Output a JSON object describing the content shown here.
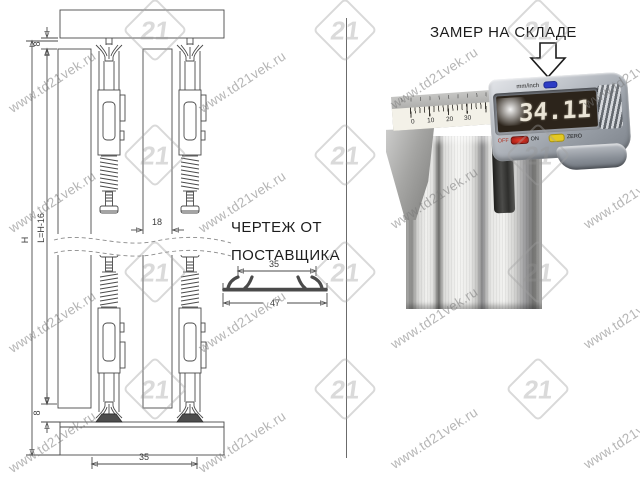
{
  "drawing": {
    "dim_h": "H",
    "dim_l": "L=H-16",
    "dim_8_top": "8",
    "dim_8_bottom": "8",
    "dim_18": "18",
    "dim_35_bottom": "35",
    "profile_dim_35": "35",
    "profile_dim_47": "47",
    "note_line1": "ЧЕРТЕЖ ОТ",
    "note_line2": "ПОСТАВЩИКА"
  },
  "photo": {
    "title": "ЗАМЕР НА СКЛАДЕ",
    "caliper": {
      "display_value": "34.11",
      "unit_label": "mm/inch",
      "off_label": "OFF",
      "on_label": "ON",
      "zero_label": "ZERO",
      "scale_ticks": [
        "0",
        "10",
        "20",
        "30"
      ],
      "colors": {
        "lcd_bg": "#2c241b",
        "unit_button": "#2d3cc5",
        "power_button": "#c62020",
        "zero_button": "#e4c922"
      }
    }
  },
  "watermark": {
    "text": "www.td21vek.ru",
    "logo_text": "21",
    "text_positions": [
      {
        "x": 10,
        "y": 102
      },
      {
        "x": 200,
        "y": 102
      },
      {
        "x": 392,
        "y": 98
      },
      {
        "x": 585,
        "y": 98
      },
      {
        "x": 10,
        "y": 222
      },
      {
        "x": 200,
        "y": 222
      },
      {
        "x": 392,
        "y": 218
      },
      {
        "x": 585,
        "y": 218
      },
      {
        "x": 10,
        "y": 342
      },
      {
        "x": 200,
        "y": 342
      },
      {
        "x": 392,
        "y": 338
      },
      {
        "x": 585,
        "y": 338
      },
      {
        "x": 10,
        "y": 462
      },
      {
        "x": 200,
        "y": 462
      },
      {
        "x": 392,
        "y": 458
      },
      {
        "x": 585,
        "y": 458
      }
    ],
    "logo_positions": [
      {
        "x": 132,
        "y": 7
      },
      {
        "x": 322,
        "y": 7
      },
      {
        "x": 515,
        "y": 7
      },
      {
        "x": 132,
        "y": 132
      },
      {
        "x": 322,
        "y": 132
      },
      {
        "x": 515,
        "y": 132
      },
      {
        "x": 132,
        "y": 249
      },
      {
        "x": 322,
        "y": 249
      },
      {
        "x": 515,
        "y": 249
      },
      {
        "x": 132,
        "y": 366
      },
      {
        "x": 322,
        "y": 366
      },
      {
        "x": 515,
        "y": 366
      }
    ]
  }
}
